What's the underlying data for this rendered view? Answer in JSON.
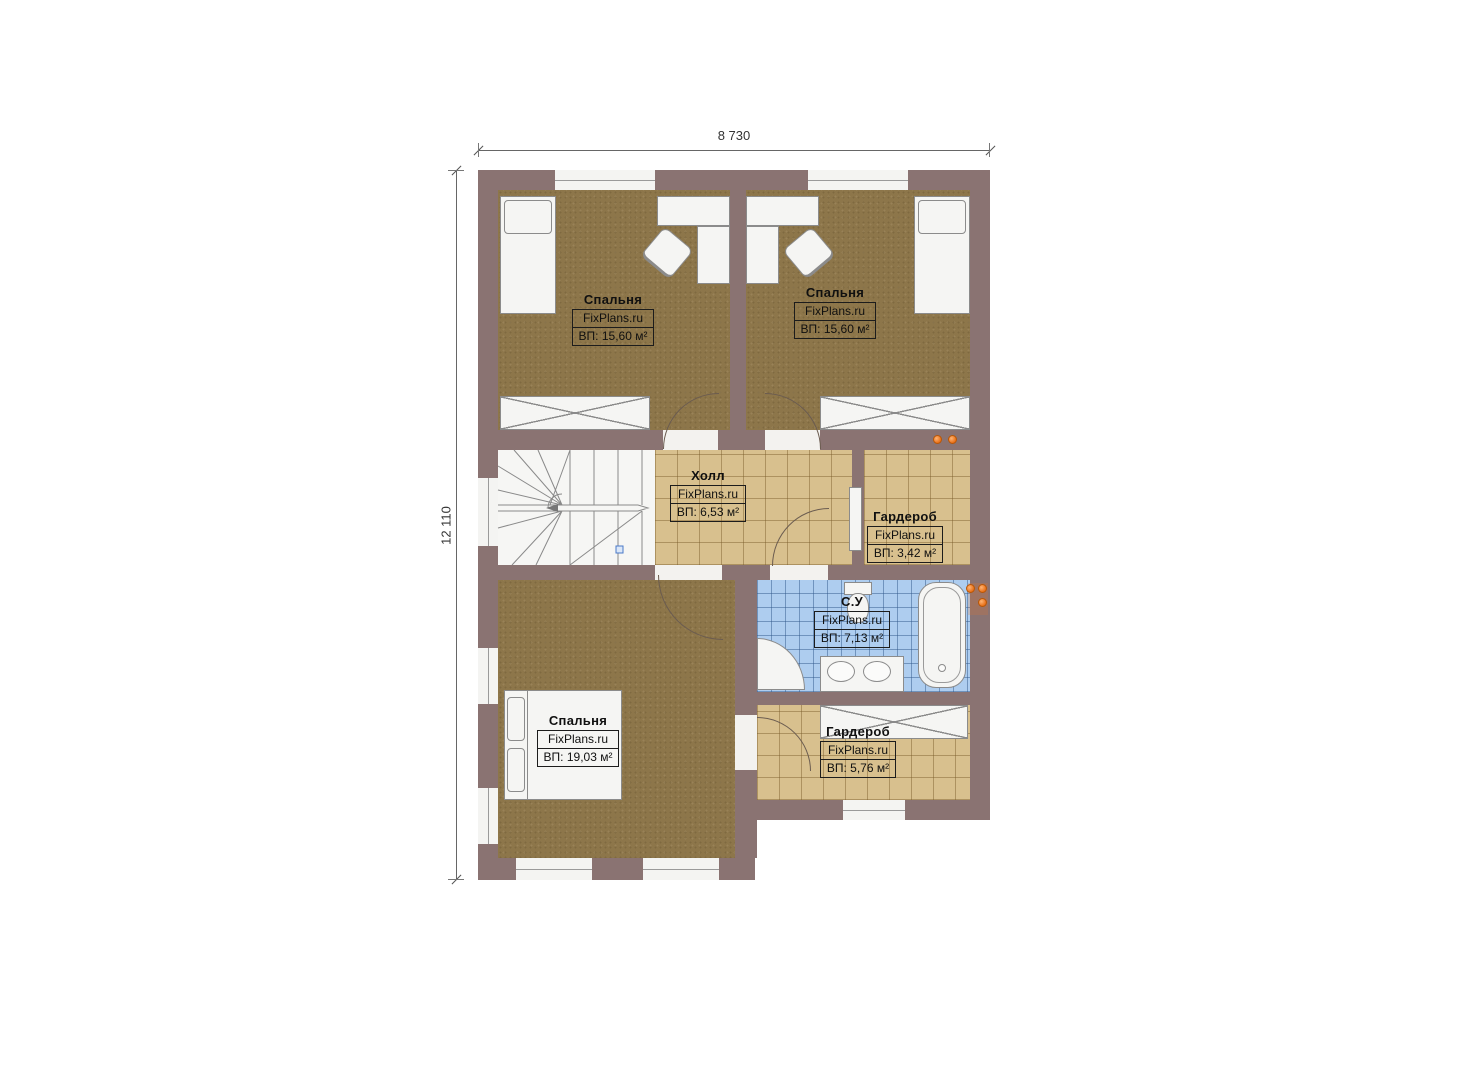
{
  "site": {
    "watermark": "FixPlans.ru"
  },
  "dimensions": {
    "width_label": "8 730",
    "height_label": "12 110"
  },
  "rooms": [
    {
      "id": "bedroom-top-left",
      "name": "Спальня",
      "watermark": "FixPlans.ru",
      "area": "ВП: 15,60 м²"
    },
    {
      "id": "bedroom-top-right",
      "name": "Спальня",
      "watermark": "FixPlans.ru",
      "area": "ВП: 15,60 м²"
    },
    {
      "id": "hall",
      "name": "Холл",
      "watermark": "FixPlans.ru",
      "area": "ВП: 6,53 м²"
    },
    {
      "id": "wardrobe-upper",
      "name": "Гардероб",
      "watermark": "FixPlans.ru",
      "area": "ВП: 3,42 м²"
    },
    {
      "id": "bathroom",
      "name": "С.У",
      "watermark": "FixPlans.ru",
      "area": "ВП: 7,13 м²"
    },
    {
      "id": "bedroom-master",
      "name": "Спальня",
      "watermark": "FixPlans.ru",
      "area": "ВП: 19,03 м²"
    },
    {
      "id": "wardrobe-lower",
      "name": "Гардероб",
      "watermark": "FixPlans.ru",
      "area": "ВП: 5,76 м²"
    }
  ],
  "colors": {
    "wall": "#8a7372",
    "carpet": "#8d764a",
    "tile_tan": "#d8c08e",
    "tile_blue": "#aecdef",
    "accent_orange": "#e87018",
    "furniture": "#f5f5f3"
  }
}
